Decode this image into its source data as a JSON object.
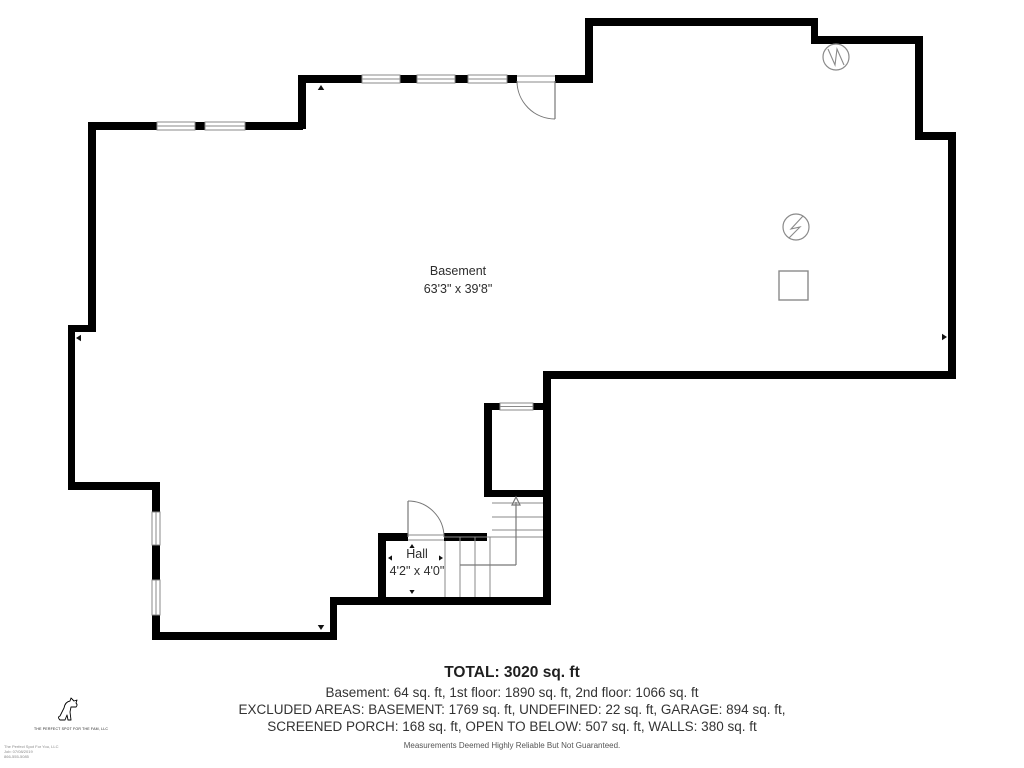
{
  "colors": {
    "wall": "#000000",
    "thin": "#8a8a8a",
    "door": "#777777",
    "arrow": "#777777",
    "dim": "#111111",
    "text": "#2d2d2d"
  },
  "rooms": [
    {
      "name": "Basement",
      "dims": "63'3\" x 39'8\"",
      "cx": 458,
      "name_y": 263,
      "dims_y": 281
    },
    {
      "name": "Hall",
      "dims": "4'2\" x 4'0\"",
      "cx": 417,
      "name_y": 546,
      "dims_y": 563
    }
  ],
  "footer": {
    "total": "TOTAL: 3020 sq. ft",
    "line1": "Basement: 64 sq. ft, 1st floor: 1890 sq. ft, 2nd floor: 1066 sq. ft",
    "line2": "EXCLUDED AREAS: BASEMENT: 1769 sq. ft, UNDEFINED: 22 sq. ft, GARAGE: 894 sq. ft,",
    "line3": "SCREENED PORCH: 168 sq. ft, OPEN TO BELOW: 507 sq. ft, WALLS: 380 sq. ft",
    "disclaimer": "Measurements Deemed Highly Reliable But Not Guaranteed."
  },
  "logo": {
    "company": "THE PERFECT SPOT FOR THE FAM, LLC",
    "footnote_lines": [
      "The Perfect Spot For You, LLC",
      "Job: 07/08/2019",
      "866-555-5085"
    ]
  },
  "floorplan": {
    "walls": [
      [
        585,
        18,
        233,
        8
      ],
      [
        811,
        18,
        7,
        26
      ],
      [
        811,
        36,
        112,
        8
      ],
      [
        915,
        36,
        8,
        103
      ],
      [
        915,
        132,
        41,
        8
      ],
      [
        948,
        132,
        8,
        247
      ],
      [
        543,
        371,
        413,
        8
      ],
      [
        543,
        371,
        8,
        234
      ],
      [
        585,
        18,
        8,
        65
      ],
      [
        298,
        75,
        64,
        8
      ],
      [
        400,
        75,
        17,
        8
      ],
      [
        455,
        75,
        13,
        8
      ],
      [
        507,
        75,
        10,
        8
      ],
      [
        555,
        75,
        38,
        8
      ],
      [
        298,
        75,
        8,
        54
      ],
      [
        88,
        122,
        69,
        8
      ],
      [
        195,
        122,
        10,
        8
      ],
      [
        245,
        122,
        58,
        8
      ],
      [
        88,
        122,
        8,
        210
      ],
      [
        68,
        325,
        28,
        7
      ],
      [
        68,
        325,
        7,
        165
      ],
      [
        68,
        482,
        92,
        8
      ],
      [
        152,
        482,
        8,
        30
      ],
      [
        152,
        545,
        8,
        35
      ],
      [
        152,
        615,
        8,
        25
      ],
      [
        152,
        632,
        185,
        8
      ],
      [
        330,
        597,
        7,
        43
      ],
      [
        330,
        597,
        221,
        8
      ],
      [
        378,
        533,
        8,
        72
      ],
      [
        378,
        533,
        30,
        8
      ],
      [
        444,
        533,
        43,
        8
      ],
      [
        484,
        403,
        8,
        94
      ],
      [
        484,
        403,
        16,
        7
      ],
      [
        533,
        403,
        10,
        7
      ],
      [
        484,
        490,
        59,
        7
      ]
    ],
    "windows": [
      {
        "x": 362,
        "y": 75,
        "w": 38,
        "h": 8,
        "o": "h"
      },
      {
        "x": 417,
        "y": 75,
        "w": 38,
        "h": 8,
        "o": "h"
      },
      {
        "x": 468,
        "y": 75,
        "w": 39,
        "h": 8,
        "o": "h"
      },
      {
        "x": 157,
        "y": 122,
        "w": 38,
        "h": 8,
        "o": "h"
      },
      {
        "x": 205,
        "y": 122,
        "w": 40,
        "h": 8,
        "o": "h"
      },
      {
        "x": 152,
        "y": 512,
        "w": 8,
        "h": 33,
        "o": "v"
      },
      {
        "x": 152,
        "y": 580,
        "w": 8,
        "h": 35,
        "o": "v"
      },
      {
        "x": 500,
        "y": 403,
        "w": 33,
        "h": 7,
        "o": "h"
      }
    ],
    "doors": [
      {
        "leaf": [
          555,
          81,
          555,
          119
        ],
        "arc": "M 517 81 A 38 38 0 0 0 555 119"
      },
      {
        "leaf": [
          408,
          501,
          408,
          537
        ],
        "arc": "M 408 501 A 36 36 0 0 1 444 537"
      }
    ],
    "thin_lines": [
      [
        517,
        76,
        555,
        76
      ],
      [
        517,
        82,
        555,
        82
      ],
      [
        408,
        535,
        444,
        535
      ],
      [
        408,
        540,
        444,
        540
      ],
      [
        492,
        503,
        543,
        503
      ],
      [
        492,
        517,
        543,
        517
      ],
      [
        492,
        530,
        543,
        530
      ],
      [
        444,
        537,
        543,
        537
      ],
      [
        445,
        541,
        445,
        597
      ],
      [
        460,
        537,
        460,
        597
      ],
      [
        475,
        537,
        475,
        597
      ],
      [
        490,
        537,
        490,
        597
      ]
    ],
    "stair_arrow": {
      "shaft": [
        [
          460,
          565,
          516,
          565
        ],
        [
          516,
          565,
          516,
          502
        ]
      ],
      "head": {
        "x": 516,
        "y": 497
      }
    },
    "dim_arrows": [
      {
        "x": 76,
        "y": 338,
        "dir": "left",
        "s": 5
      },
      {
        "x": 947,
        "y": 337,
        "dir": "right",
        "s": 5
      },
      {
        "x": 321,
        "y": 85,
        "dir": "up",
        "s": 5
      },
      {
        "x": 321,
        "y": 630,
        "dir": "down",
        "s": 5
      },
      {
        "x": 388,
        "y": 558,
        "dir": "left",
        "s": 4
      },
      {
        "x": 443,
        "y": 558,
        "dir": "right",
        "s": 4
      },
      {
        "x": 412,
        "y": 544,
        "dir": "up",
        "s": 4
      },
      {
        "x": 412,
        "y": 594,
        "dir": "down",
        "s": 4
      }
    ],
    "symbols": {
      "circles": [
        {
          "cx": 796,
          "cy": 227,
          "r": 13,
          "path": "M 803 216 L 791 229 L 800 227 L 789 238",
          "name": "electrical-panel-symbol"
        },
        {
          "cx": 836,
          "cy": 57,
          "r": 13,
          "path": "M 828 49 L 835 65 L 837 49 L 844 65",
          "name": "utility-meter-symbol"
        }
      ],
      "square": {
        "x": 779,
        "y": 271,
        "w": 29,
        "h": 29,
        "name": "fixture-square-symbol"
      }
    }
  }
}
